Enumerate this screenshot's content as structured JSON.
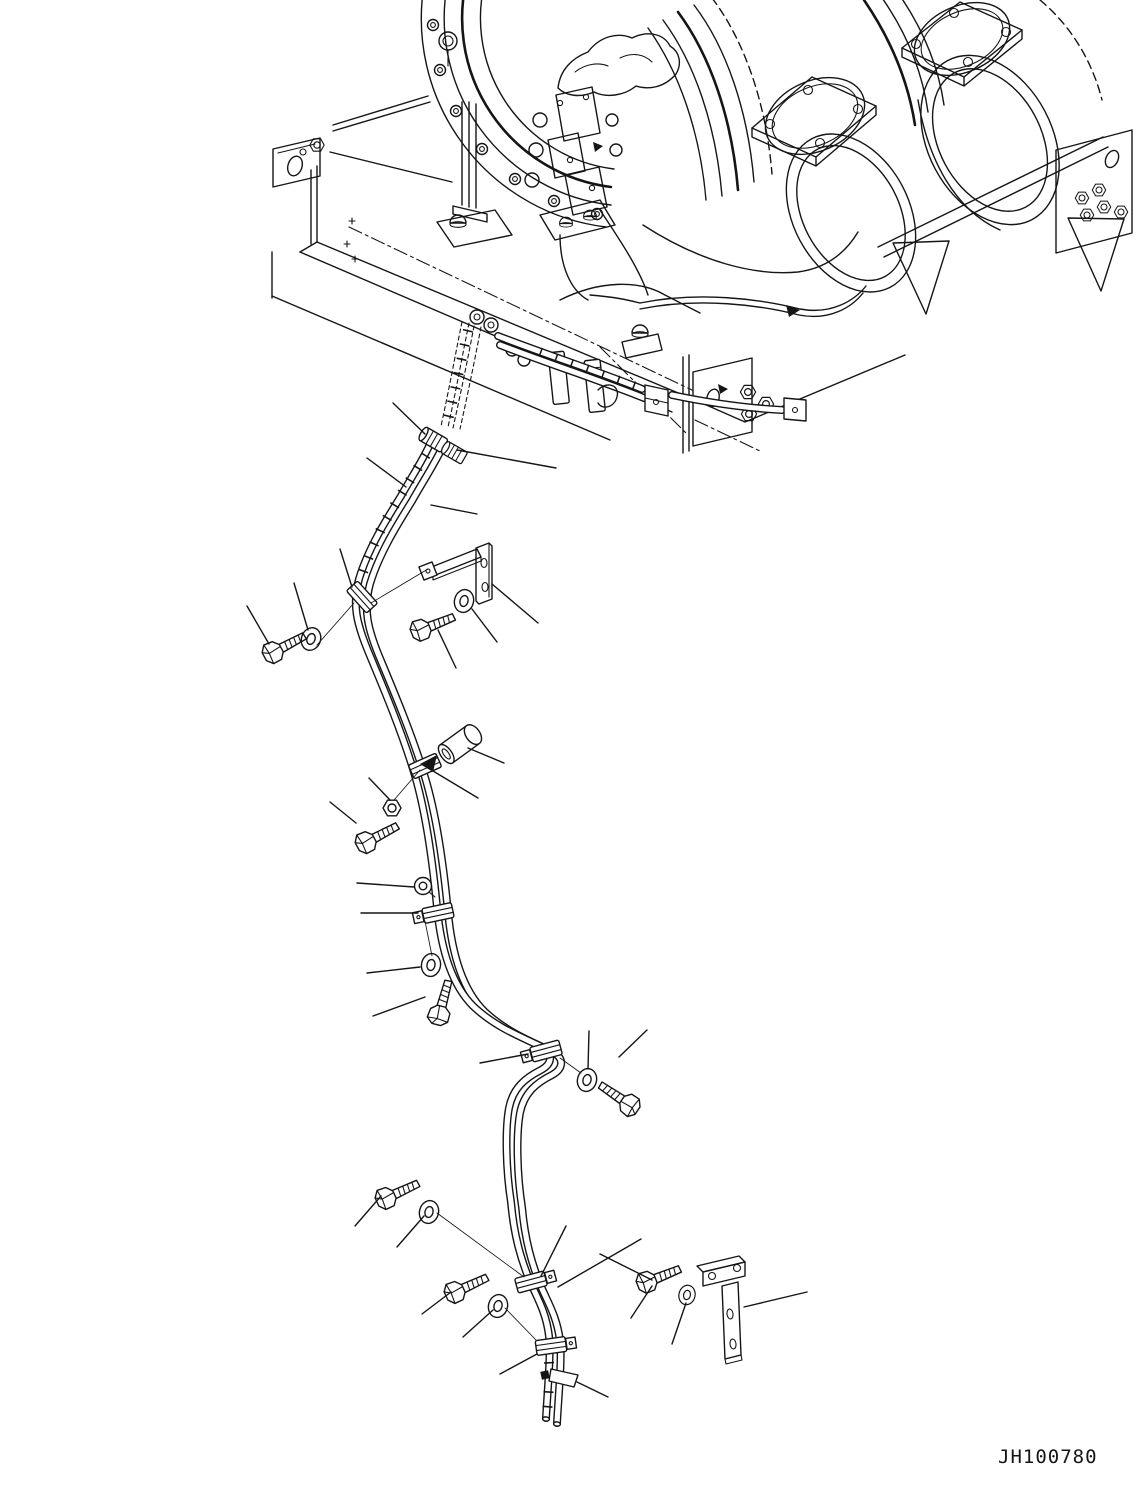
{
  "page": {
    "background": "#ffffff",
    "ink": "#151515"
  },
  "drawing": {
    "number": "JH100780",
    "view": "isometric line drawing",
    "subject": "muffler piping and drain tube mounting, exploded parts view",
    "assemblies": [
      {
        "name": "muffler-assembly",
        "elements": [
          "left muffler end face with bolt ring",
          "center muffler outlet flange and open end",
          "right muffler outlet flange and open end",
          "clamp band straps",
          "valve and actuator cluster"
        ]
      },
      {
        "name": "mounting-frame",
        "elements": [
          "base plate",
          "left end channel",
          "support posts",
          "cross members",
          "gusset plates",
          "nut plate with hex nuts",
          "dash-dot center lines"
        ]
      },
      {
        "name": "tube-routing",
        "elements": [
          "twin tube with s-curve routing",
          "hidden upper tube stub",
          "tube unions",
          "pipe clamps",
          "open tube lower ends",
          "identification flag"
        ]
      }
    ],
    "callout_parts": [
      {
        "id": "tube-union-1",
        "type": "tube-union"
      },
      {
        "id": "tube-union-2",
        "type": "tube-union"
      },
      {
        "id": "hex-bolt-1",
        "type": "hex-bolt"
      },
      {
        "id": "spring-washer-1",
        "type": "spring-washer"
      },
      {
        "id": "l-bracket",
        "type": "mounting-bracket"
      },
      {
        "id": "hex-bolt-2",
        "type": "hex-bolt"
      },
      {
        "id": "spring-washer-2",
        "type": "spring-washer"
      },
      {
        "id": "end-cap",
        "type": "cap-sleeve"
      },
      {
        "id": "hex-nut-1",
        "type": "hex-nut"
      },
      {
        "id": "hex-bolt-3",
        "type": "hex-bolt"
      },
      {
        "id": "grommet-clip",
        "type": "grommet"
      },
      {
        "id": "tube-clamp-1",
        "type": "tube-clamp"
      },
      {
        "id": "spring-washer-3",
        "type": "spring-washer"
      },
      {
        "id": "hex-bolt-4",
        "type": "hex-bolt"
      },
      {
        "id": "tube-clamp-2",
        "type": "tube-clamp"
      },
      {
        "id": "spring-washer-4",
        "type": "spring-washer"
      },
      {
        "id": "hex-bolt-5",
        "type": "hex-bolt"
      },
      {
        "id": "hex-bolt-6",
        "type": "hex-bolt"
      },
      {
        "id": "spring-washer-5",
        "type": "spring-washer"
      },
      {
        "id": "tube-clamp-3",
        "type": "tube-clamp"
      },
      {
        "id": "hex-bolt-7",
        "type": "hex-bolt"
      },
      {
        "id": "spring-washer-6",
        "type": "spring-washer"
      },
      {
        "id": "tube-clamp-4",
        "type": "tube-clamp"
      },
      {
        "id": "hex-bolt-8",
        "type": "hex-bolt"
      },
      {
        "id": "spring-washer-7",
        "type": "spring-washer"
      },
      {
        "id": "t-bracket",
        "type": "mounting-bracket"
      }
    ]
  }
}
